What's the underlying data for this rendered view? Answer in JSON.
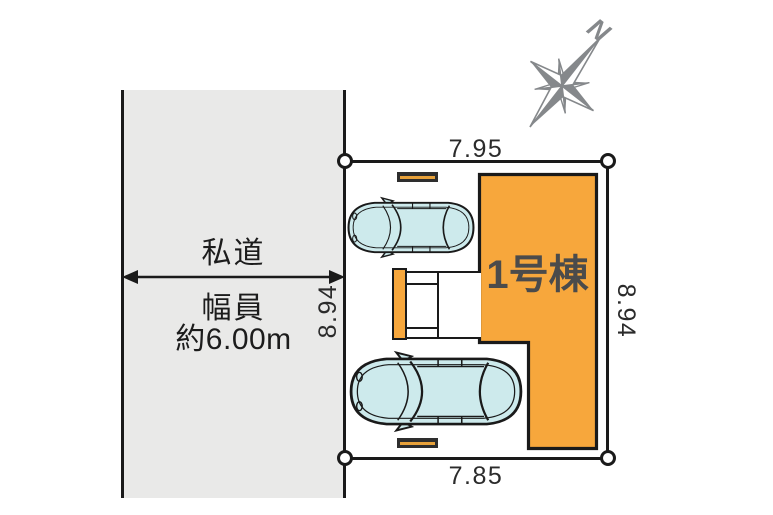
{
  "road": {
    "name_label": "私道",
    "width_caption": "幅員",
    "width_value": "約6.00m",
    "fill_color": "#e9e9e8"
  },
  "plot": {
    "dim_top": "7.95",
    "dim_bottom": "7.85",
    "dim_left": "8.94",
    "dim_right": "8.94"
  },
  "building": {
    "label": "1号棟",
    "fill_color": "#f7a73c"
  },
  "compass": {
    "north_label": "N",
    "color": "#85888b"
  },
  "colors": {
    "outline": "#1a1a1a",
    "car_fill": "#cdeaec",
    "accent_orange": "#f7a73c",
    "building_label_text": "#4b4b4b"
  }
}
